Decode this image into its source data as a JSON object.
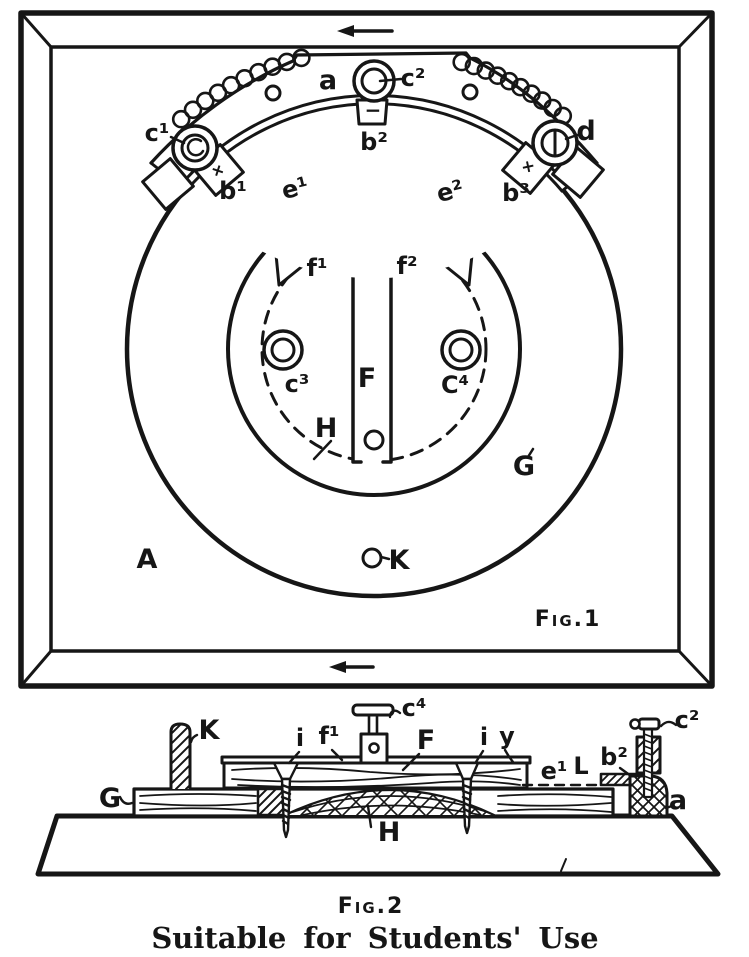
{
  "colors": {
    "ink": "#161616",
    "paper": "#ffffff"
  },
  "fig1": {
    "caption": "Fig.1",
    "labels": {
      "a": "a",
      "c1": "c¹",
      "c2": "c²",
      "d": "d",
      "b1": "b¹",
      "b2": "b²",
      "b3": "b³",
      "plus_left": "+",
      "plus_right": "+",
      "minus": "−",
      "e1": "e¹",
      "e2": "e²",
      "f1": "f¹",
      "f2": "f²",
      "F": "F",
      "c3": "c³",
      "c4": "C⁴",
      "H": "H",
      "G": "G",
      "A": "A",
      "K": "K"
    }
  },
  "fig2": {
    "caption": "Fig.2",
    "labels": {
      "K": "K",
      "G": "G",
      "i1": "i",
      "f1": "f¹",
      "c4": "c⁴",
      "F": "F",
      "i2": "i",
      "y": "y",
      "e1": "e¹",
      "L": "L",
      "b2": "b²",
      "c2": "c²",
      "a": "a",
      "H": "H"
    }
  },
  "caption": "Suitable for Students' Use"
}
